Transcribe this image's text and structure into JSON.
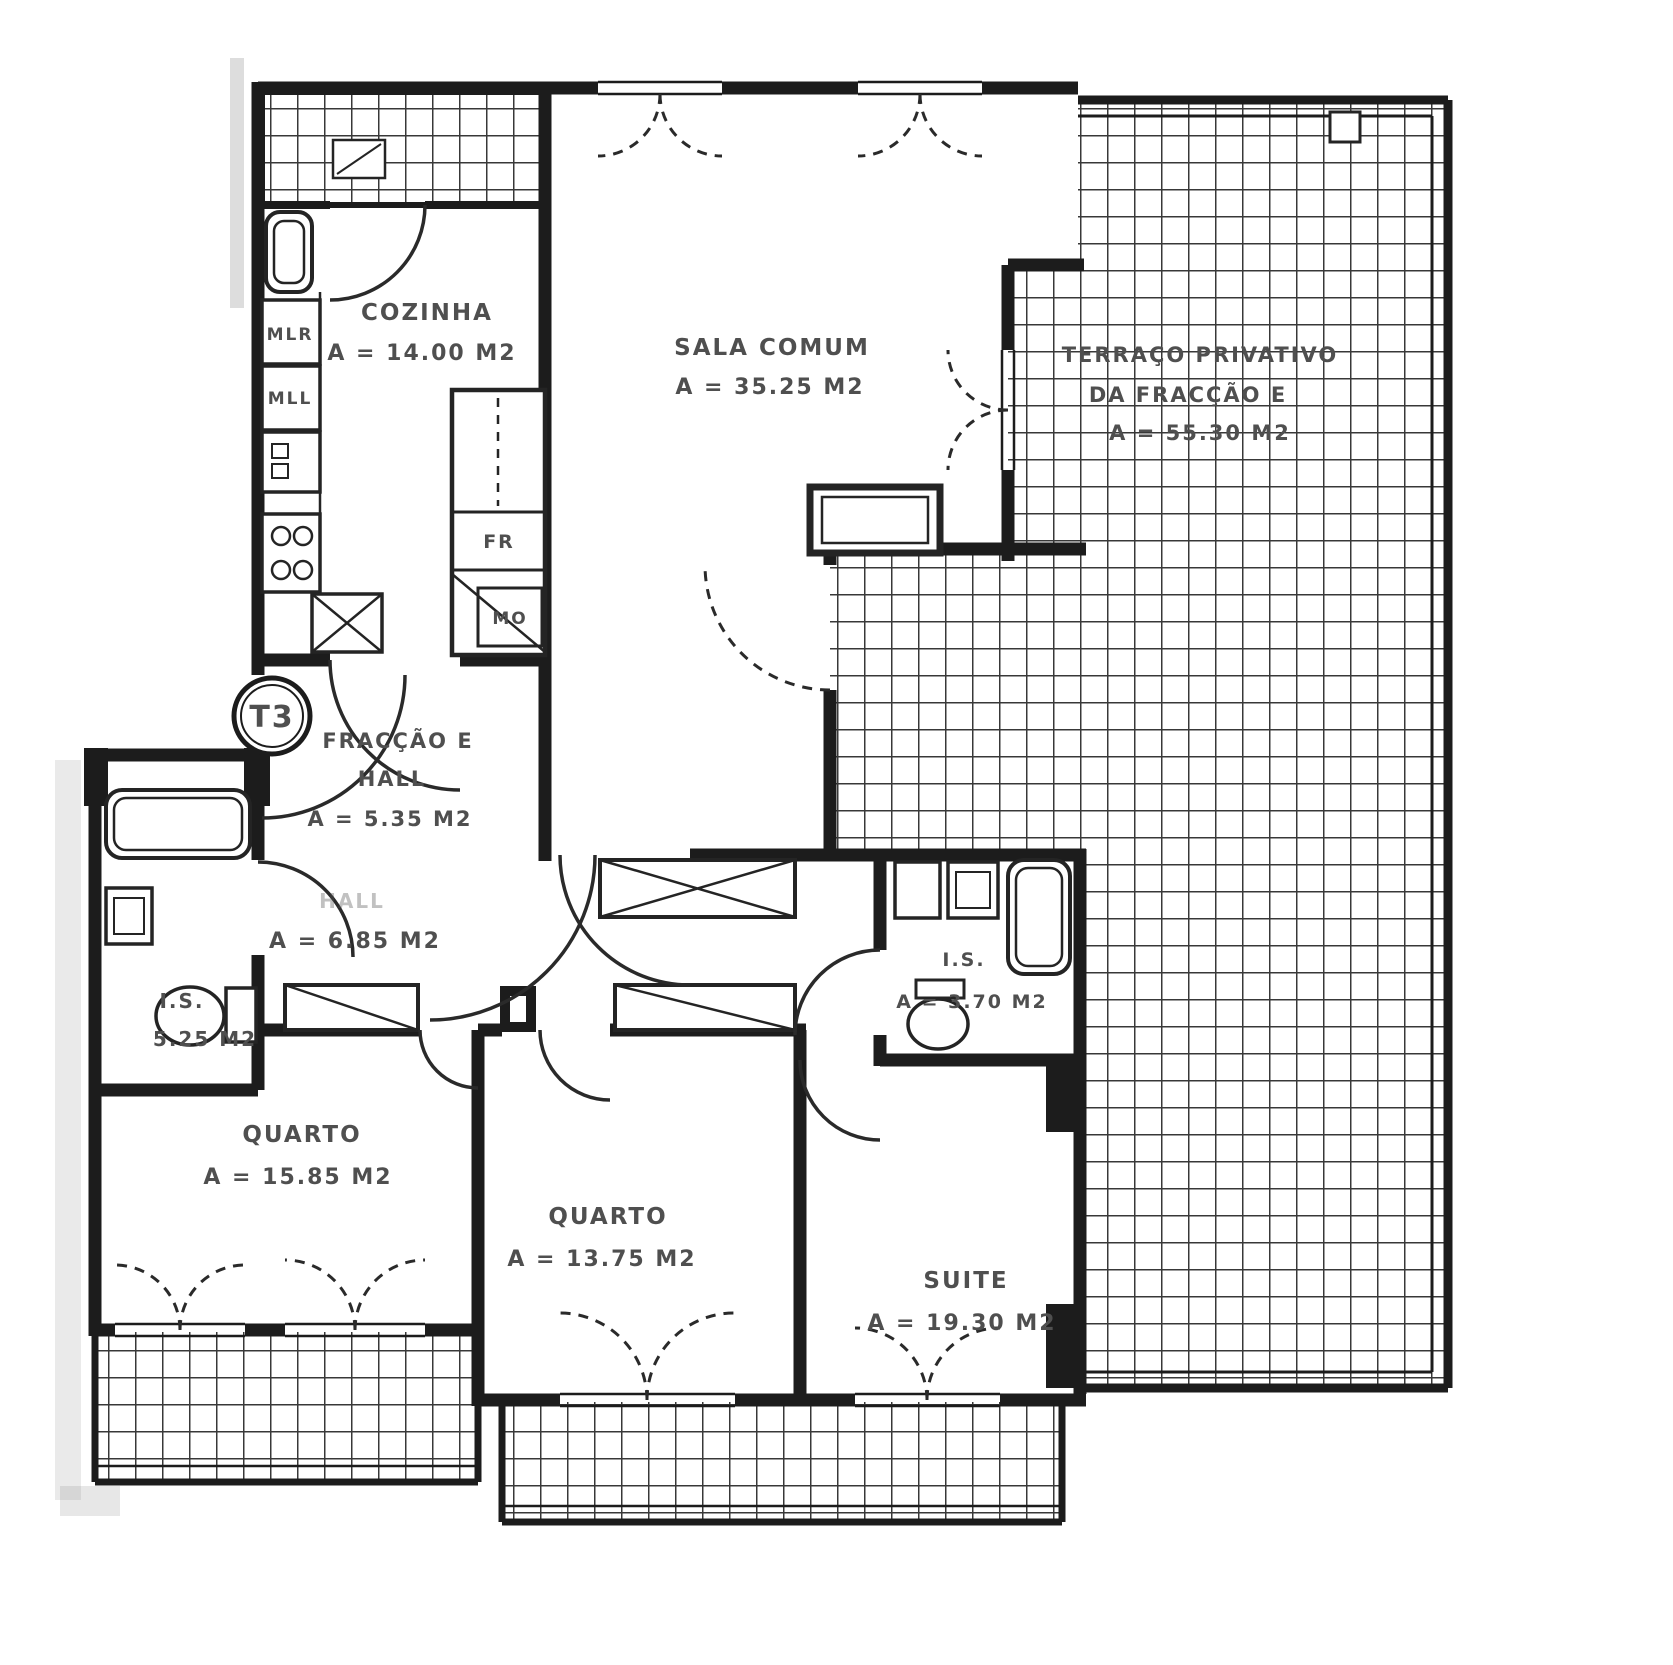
{
  "document": {
    "type": "apartment floor plan (scanned)",
    "unit_badge": "T3"
  },
  "rooms": {
    "cozinha": {
      "name": "COZINHA",
      "area": "A = 14.00 M2"
    },
    "sala_comum": {
      "name": "SALA COMUM",
      "area": "A = 35.25 M2"
    },
    "terraco": {
      "name_line1": "TERRAÇO PRIVATIVO",
      "name_line2": "DA FRACÇÃO E",
      "area": "A = 55.30 M2"
    },
    "hall_entrada": {
      "name_line1": "FRACÇÃO E",
      "name_line2": "HALL",
      "area": "A = 5.35 M2"
    },
    "hall_interior": {
      "name": "HALL",
      "area": "A = 6.85 M2"
    },
    "is_esquerda": {
      "name": "I.S.",
      "area": "5.25 M2"
    },
    "is_suite": {
      "name": "I.S.",
      "area": "A = 3.70 M2"
    },
    "quarto_1": {
      "name": "QUARTO",
      "area": "A = 15.85 M2"
    },
    "quarto_2": {
      "name": "QUARTO",
      "area": "A = 13.75 M2"
    },
    "suite": {
      "name": "SUITE",
      "area": "A = 19.30 M2"
    }
  },
  "kitchen_appliances": {
    "mlr": "MLR",
    "mll": "MLL",
    "fr": "FR",
    "mo": "MO"
  },
  "colors": {
    "ink": "#1c1c1c",
    "label_text": "#4f4f4f",
    "paper": "#ffffff",
    "tile_line": "#383838"
  }
}
